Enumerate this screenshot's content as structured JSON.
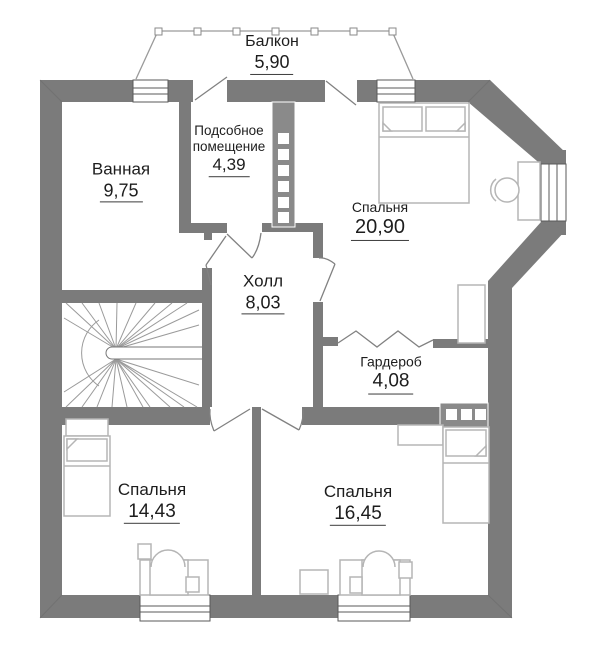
{
  "plan_title": "floor-plan-second-level",
  "rooms": {
    "balcony": {
      "name": "Балкон",
      "area": "5,90"
    },
    "bathroom": {
      "name": "Ванная",
      "area": "9,75"
    },
    "utility": {
      "name_line1": "Подсобное",
      "name_line2": "помещение",
      "area": "4,39"
    },
    "bedroom1": {
      "name": "Спальня",
      "area": "20,90"
    },
    "hall": {
      "name": "Холл",
      "area": "8,03"
    },
    "wardrobe": {
      "name": "Гардероб",
      "area": "4,08"
    },
    "bedroom2": {
      "name": "Спальня",
      "area": "14,43"
    },
    "bedroom3": {
      "name": "Спальня",
      "area": "16,45"
    }
  },
  "colors": {
    "wall": "#7b7b7b",
    "shaft": "#8a8a8a",
    "furniture_stroke": "#b5b5b5",
    "stair_line": "#9a9a9a",
    "door_line": "#818181",
    "window_stroke": "#5a5a5a",
    "text": "#1d1d1d",
    "background": "#ffffff"
  }
}
